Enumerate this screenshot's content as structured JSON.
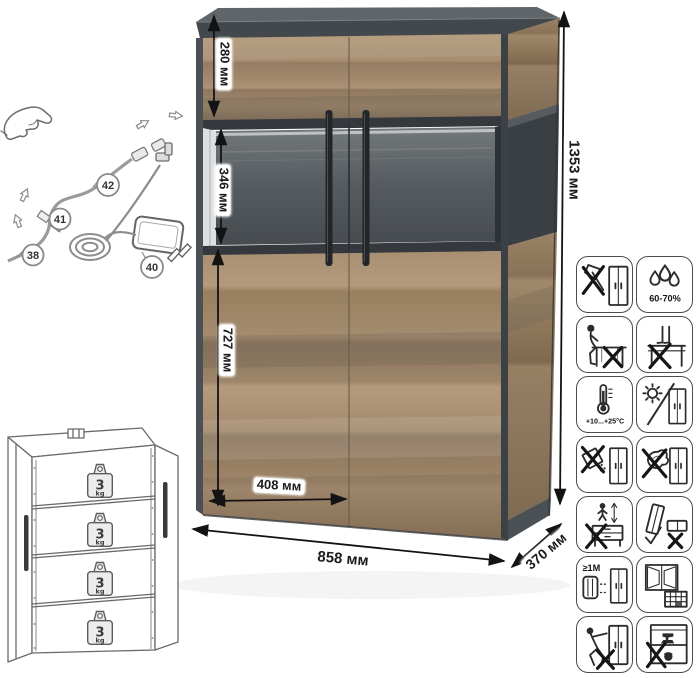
{
  "product": {
    "type": "display-cabinet-infographic"
  },
  "dimensions": {
    "total_height": "1353 мм",
    "total_width": "858 мм",
    "depth": "370 мм",
    "top_section": "280 мм",
    "glass_section": "346 мм",
    "bottom_section": "727 мм",
    "door_width": "408 мм"
  },
  "shelf_load": {
    "value": "3",
    "unit": "kg"
  },
  "assembly_callouts": [
    {
      "name": "led-cable",
      "number": "42"
    },
    {
      "name": "connector",
      "number": "41"
    },
    {
      "name": "led-strip",
      "number": "38"
    },
    {
      "name": "power-adapter",
      "number": "40"
    }
  ],
  "care_icons": [
    {
      "name": "no-sharp-tools-icon"
    },
    {
      "name": "humidity-icon",
      "label": "60-70%"
    },
    {
      "name": "no-sitting-icon"
    },
    {
      "name": "no-standing-icon"
    },
    {
      "name": "temperature-range-icon",
      "label": "+10...+25°C"
    },
    {
      "name": "no-direct-sunlight-icon"
    },
    {
      "name": "no-abrasive-cleaners-icon"
    },
    {
      "name": "no-wet-cleaning-icon"
    },
    {
      "name": "no-jumping-icon"
    },
    {
      "name": "transport-upright-icon"
    },
    {
      "name": "heat-distance-icon",
      "label": "≥1M"
    },
    {
      "name": "ventilate-room-icon"
    },
    {
      "name": "no-dragging-icon"
    },
    {
      "name": "no-overload-icon"
    }
  ],
  "colors": {
    "wood": "#a48b6e",
    "frame_dark": "#454b4f",
    "interior_back": "#53585c",
    "handle": "#27292b",
    "line_art": "#5d5d5d"
  }
}
